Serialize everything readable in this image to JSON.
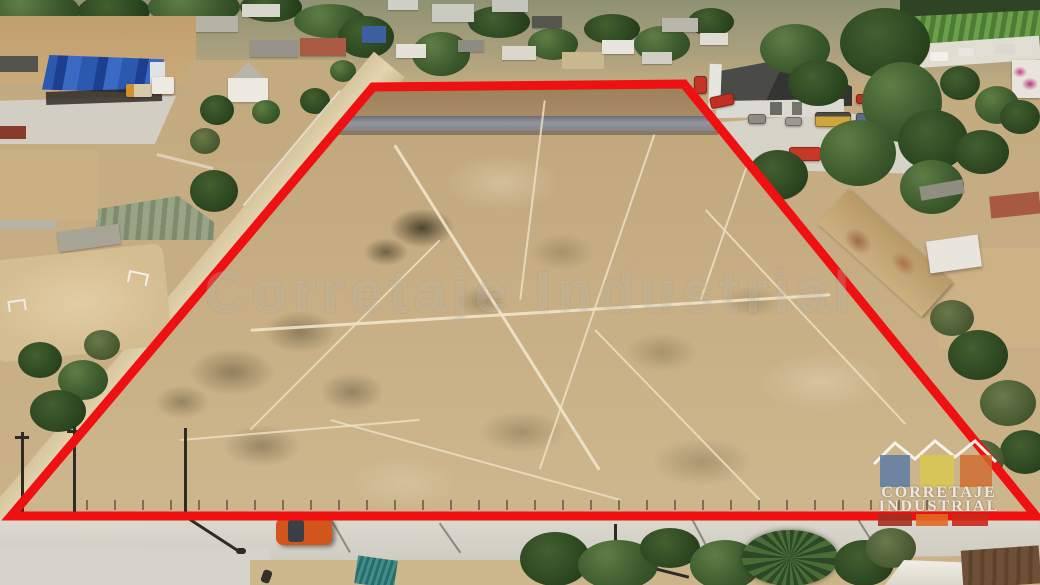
{
  "watermark": {
    "text": "Corretaje Industrial"
  },
  "logo": {
    "line1": "CORRETAJE",
    "line2": "INDUSTRIAL"
  },
  "colors": {
    "outline_red": "#ef1111",
    "logo_square_blue": "#5c7da3",
    "logo_square_yellow": "#d9c94a",
    "logo_square_orange": "#cf6a2a",
    "logo_bar_darkred": "#a33020",
    "logo_bar_orange": "#e06a25",
    "logo_bar_red": "#cc2818",
    "logo_roofline_white": "#f5f3ec"
  }
}
